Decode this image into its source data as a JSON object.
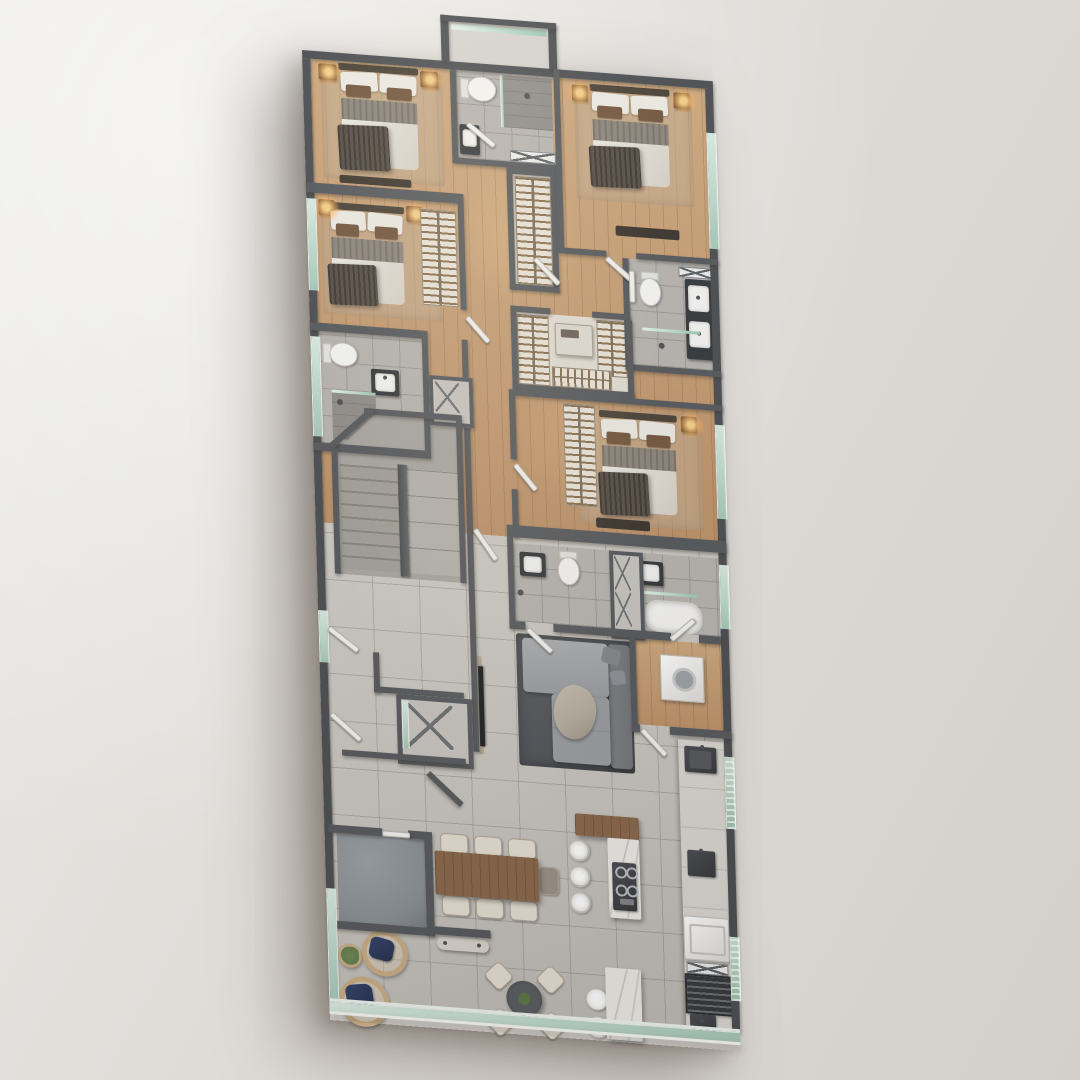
{
  "scene": {
    "kind": "3d-rendered-floor-plan",
    "view": "top-down axonometric",
    "description": "Photorealistic top-down render of an apartment floor plan on a plain light-gray backdrop; no text labels visible"
  },
  "palette": {
    "background_top": "#ecebe8",
    "background_bottom": "#d3cfca",
    "wall": "#56595d",
    "wall_dark": "#4b4e52",
    "wood_floor": "#cda87e",
    "wood_floor_dark": "#bd9269",
    "tile_floor": "#c8c5c0",
    "bath_floor": "#b7b4b0",
    "stair_floor": "#a9a6a2",
    "closet_floor": "#e2ddd4",
    "storage_floor": "#8a9096",
    "glass": "#bcd8cb",
    "glass_frame": "#eef4ef",
    "bed_linen": "#eceae3",
    "bed_quilt": "#8d867d",
    "bed_blanket": "#574f47",
    "pillow_brown": "#74573f",
    "headboard": "#4a4237",
    "lamp_glow": "#ffb25c",
    "rug_dark": "#4b4e54",
    "sofa_base": "#9a9da2",
    "sofa_back": "#72757a",
    "throw": "#b5ad9f",
    "wood_table": "#8a684c",
    "marble": "#edebe7",
    "chair_cream": "#e6dfd3",
    "navy": "#253150",
    "rattan": "#c9ae86",
    "plant": "#5d7847",
    "steel_dark": "#35383c",
    "counter": "#dad7d2",
    "hanger_wood": "#8a6f4d",
    "tv_black": "#1e1f21"
  },
  "rooms": [
    {
      "name": "bedroom-1",
      "furniture": [
        "double-bed",
        "nightstands",
        "table-lamps",
        "area-rug",
        "foot-console"
      ]
    },
    {
      "name": "bedroom-2",
      "furniture": [
        "double-bed",
        "nightstands",
        "table-lamps",
        "closet-rail",
        "area-rug"
      ]
    },
    {
      "name": "bedroom-3",
      "furniture": [
        "double-bed",
        "nightstands",
        "table-lamps",
        "dresser",
        "area-rug"
      ]
    },
    {
      "name": "bedroom-4",
      "furniture": [
        "double-bed",
        "nightstands",
        "table-lamps",
        "closet-rail",
        "tv-console",
        "area-rug"
      ]
    },
    {
      "name": "bathroom-1",
      "furniture": [
        "toilet",
        "vanity-sink",
        "walk-in-shower"
      ]
    },
    {
      "name": "bathroom-2",
      "furniture": [
        "toilet",
        "vanity-sink",
        "glass-shower",
        "towel-rack"
      ]
    },
    {
      "name": "bathroom-3-master",
      "furniture": [
        "toilet",
        "double-vanity",
        "shower",
        "towel-rack",
        "glass-shelf"
      ]
    },
    {
      "name": "bathroom-4",
      "furniture": [
        "toilet",
        "vanity-sink",
        "shower-head"
      ]
    },
    {
      "name": "bathroom-5",
      "furniture": [
        "bathtub",
        "vanity-sink",
        "glass-shelf"
      ]
    },
    {
      "name": "hallway-closet",
      "furniture": [
        "hanging-rail"
      ]
    },
    {
      "name": "walk-in-closet",
      "furniture": [
        "hanging-rails",
        "island-dresser"
      ]
    },
    {
      "name": "stairwell",
      "furniture": [
        "two-flight-stair",
        "central-stringer"
      ]
    },
    {
      "name": "elevator-shaft",
      "furniture": [
        "x-brace",
        "glass-door"
      ]
    },
    {
      "name": "service-ducts",
      "furniture": [
        "x-brace"
      ]
    },
    {
      "name": "living-room",
      "furniture": [
        "sectional-sofa",
        "cushions",
        "throw-blanket",
        "dark-rug",
        "wall-tv",
        "media-panel"
      ]
    },
    {
      "name": "dining-area",
      "furniture": [
        "wood-dining-table",
        "six-cream-chairs",
        "end-chair"
      ]
    },
    {
      "name": "kitchen",
      "furniture": [
        "l-shaped-island",
        "cooktop",
        "bar-stools",
        "counter-run",
        "steel-sinks",
        "oven",
        "grill-grate",
        "washer"
      ]
    },
    {
      "name": "breakfast-nook",
      "furniture": [
        "round-table",
        "four-chairs",
        "centerpiece-plant"
      ]
    },
    {
      "name": "lounge-corner",
      "furniture": [
        "rattan-armchair-navy",
        "rattan-armchair-navy",
        "potted-plant"
      ]
    },
    {
      "name": "storage-room",
      "furniture": []
    },
    {
      "name": "entry-console",
      "furniture": [
        "console-shelf",
        "marble-side-table",
        "two-stools"
      ]
    },
    {
      "name": "balcony-edge",
      "furniture": [
        "glass-balustrade"
      ]
    },
    {
      "name": "light-well",
      "furniture": [
        "glass-railing"
      ]
    }
  ]
}
